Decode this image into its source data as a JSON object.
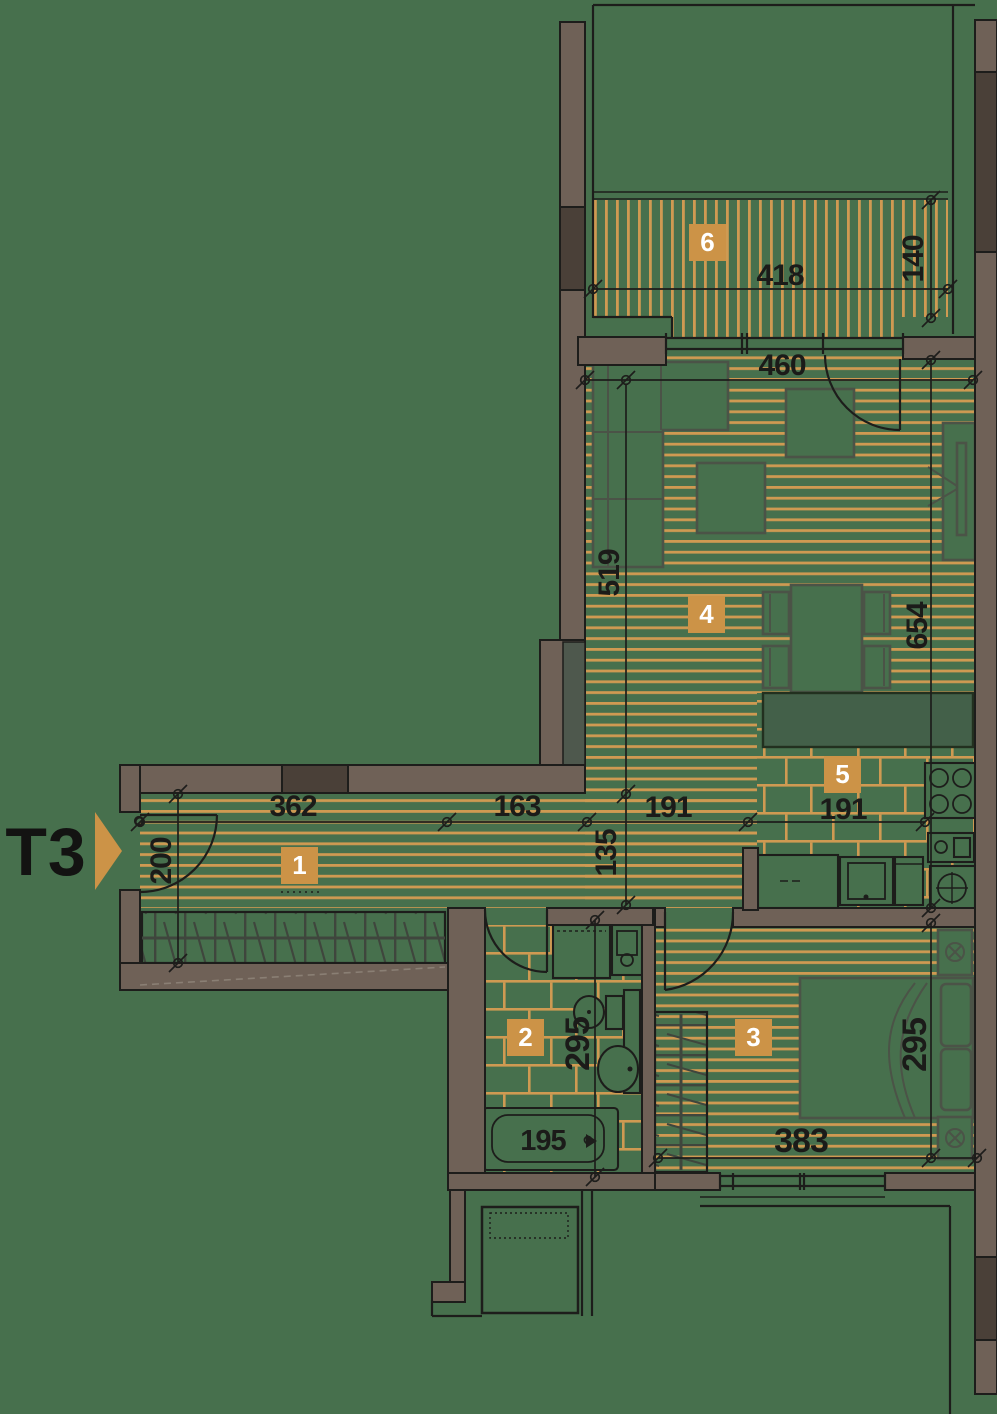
{
  "unit_label": "T3",
  "colors": {
    "background": "#47704d",
    "stripe_accent": "#cf9a52",
    "wall": "#6f6157",
    "wall_window_dark": "#4a4038",
    "badge": "#cc9347",
    "line": "#1d1d1b"
  },
  "rooms": [
    {
      "number": "1"
    },
    {
      "number": "2"
    },
    {
      "number": "3"
    },
    {
      "number": "4"
    },
    {
      "number": "5"
    },
    {
      "number": "6"
    }
  ],
  "dimensions": {
    "balcony_width": "418",
    "balcony_depth": "140",
    "living_width": "460",
    "living_left_depth": "519",
    "living_right_depth": "654",
    "hall_segment_1": "362",
    "hall_segment_2": "163",
    "hall_segment_3": "191",
    "kitchen_width": "191",
    "hall_depth": "135",
    "entry_width": "200",
    "bathroom_depth": "295",
    "bathtub_length": "195",
    "bedroom_width": "383",
    "bedroom_depth": "295"
  }
}
